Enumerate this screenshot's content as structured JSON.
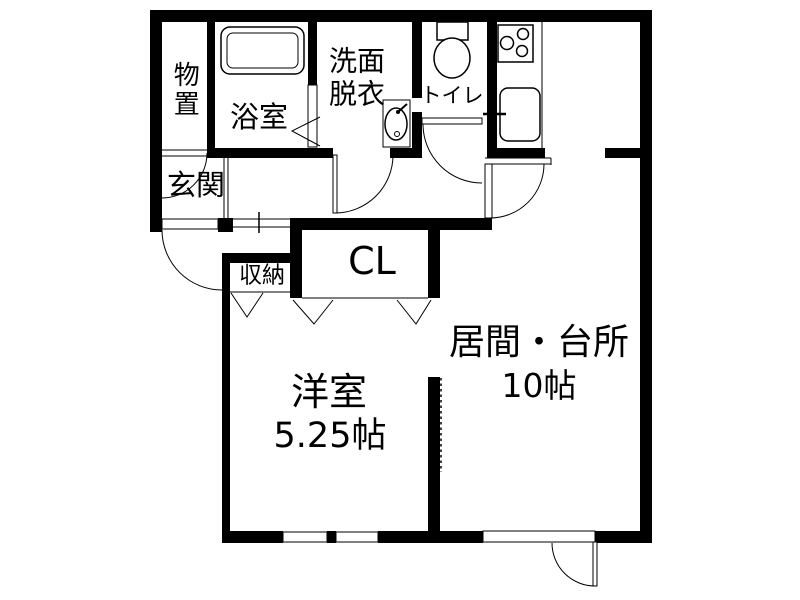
{
  "plan_title": "1LDK apartment floor plan",
  "colors": {
    "wall": "#000000",
    "floor": "#ffffff",
    "text": "#000000"
  },
  "rooms": {
    "monooki": {
      "label": "物置"
    },
    "yokushitsu": {
      "label": "浴室"
    },
    "senmen": {
      "label_line1": "洗面",
      "label_line2": "脱衣"
    },
    "toire": {
      "label": "トイレ"
    },
    "genkan": {
      "label": "玄関"
    },
    "shuno": {
      "label": "収納"
    },
    "closet": {
      "label": "CL"
    },
    "yoshitsu": {
      "label": "洋室",
      "size": "5.25帖"
    },
    "ima": {
      "label": "居間・台所",
      "size": "10帖"
    }
  },
  "fixtures": {
    "bathtub": "bathtub",
    "toilet_bowl": "toilet-bowl",
    "washbasin": "washbasin",
    "stove": "gas-stove-3-burner",
    "sink": "kitchen-sink"
  }
}
